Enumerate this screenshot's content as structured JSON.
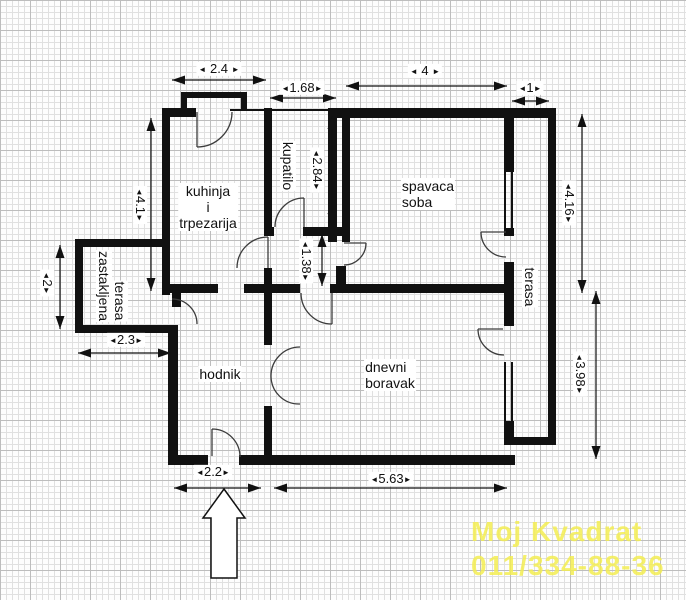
{
  "glyphs": {
    "dim_left": "◄",
    "dim_right": "►"
  },
  "rooms": {
    "kitchen": {
      "line1": "kuhinja",
      "line2": "i",
      "line3": "trpezarija"
    },
    "bathroom": {
      "label": "kupatilo"
    },
    "bedroom": {
      "line1": "spavaca",
      "line2": "soba"
    },
    "terrace": {
      "label": "terasa"
    },
    "living_room": {
      "line1": "dnevni",
      "line2": "boravak"
    },
    "hallway": {
      "label": "hodnik"
    },
    "glazed_terrace": {
      "line1": "zastakljena",
      "line2": "terasa"
    }
  },
  "dimensions_m": {
    "kitchen_width": "2.4",
    "bathroom_width": "1.68",
    "bedroom_width": "4",
    "terrace_width": "1",
    "kitchen_height": "4.1",
    "glazed_terrace_height": "2",
    "bathroom_height": "2.84",
    "passage_height": "1.38",
    "right_side_upper": "4.16",
    "right_side_lower": "3.98",
    "glazed_terrace_width": "2.3",
    "entrance_width": "2.2",
    "living_room_width": "5.63"
  },
  "watermark": {
    "line1": "Moj Kvadrat",
    "line2": "011/334-88-36",
    "color": "#f4ee52"
  }
}
